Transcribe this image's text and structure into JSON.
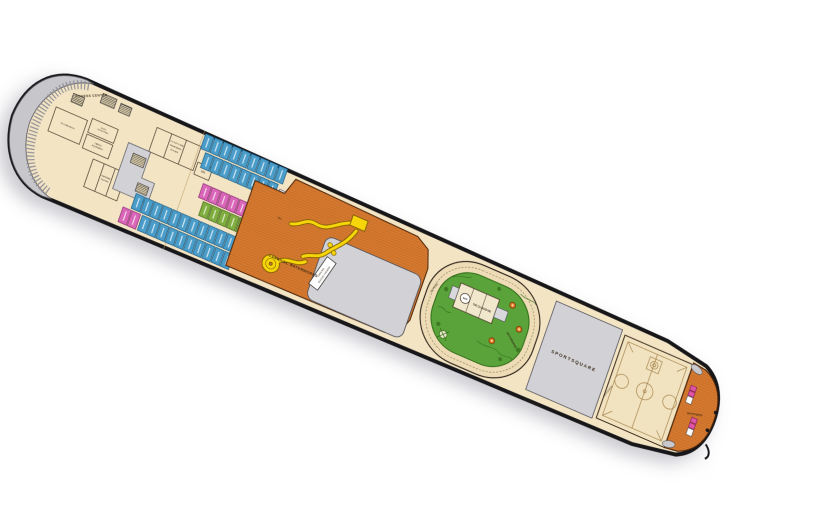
{
  "page": {
    "background": "#ffffff",
    "description_labels_only": true
  },
  "colors": {
    "deck_beige": "#f3e4c4",
    "hull_outline": "#17171a",
    "open_space_gray": "#d2d2d6",
    "bow_crescent_gray": "#c6c6cb",
    "orange_deck": "#d4792f",
    "orange_plank": "#b35d1e",
    "waterslide_yellow": "#f6d60a",
    "mini_golf_green": "#5aa33a",
    "cabin_blue": "#4a9cc9",
    "cabin_blue_dark": "#1d5f88",
    "cabin_pink": "#d966b8",
    "cabin_pink_dark": "#8d2f74",
    "cabin_green": "#7fae3e",
    "cabin_green_dark": "#4a6b1f",
    "court_line": "#a8854e",
    "label_dark": "#3a2a1a",
    "open_label_gray": "#8b8b93",
    "golf_hole_orange": "#e07820"
  },
  "deck": {
    "labels": {
      "fitness_center": "FITNESS CENTER",
      "plyometrics": "PLYOMETRICS",
      "body_sculpting": [
        "BODY",
        "SCULPTING"
      ],
      "cardio": [
        "CARDIO",
        "EQUIPMENT"
      ],
      "thermal_suites": [
        "THERMAL",
        "SUITES"
      ],
      "cloud9_spa": [
        "CLOUD 9 SPA",
        "TREATMENT",
        "ROOMS"
      ],
      "spa": "SPA",
      "wc": "WC",
      "waterworks": "CARNIVAL WATERWORKS",
      "seaside_theatre": [
        "CARNIVAL",
        "SEASIDE THEATRE"
      ],
      "skyride": "SKYRIDE",
      "bar": "BAR",
      "the_clubhouse": "THE CLUBHOUSE",
      "skygreens": "SKYGREENS",
      "skycourse_top": "SKYCOURSE",
      "skycourse_bottom": "SKYCOURSE",
      "skycourse_court": "SKYCOURSE",
      "sportsquare": "SPORTSQUARE",
      "skyfitness": "SKYFITNESS"
    },
    "cabin_rows": [
      {
        "y": 8,
        "x0": 196,
        "count": 9,
        "w": 9,
        "h": 16,
        "gap": 1,
        "color": "blue"
      },
      {
        "y": 26,
        "x0": 202,
        "count": 8,
        "w": 9,
        "h": 16,
        "gap": 1,
        "color": "blue"
      },
      {
        "y": 56,
        "x0": 210,
        "count": 6,
        "w": 9,
        "h": 15,
        "gap": 1,
        "color": "pink"
      },
      {
        "y": 73,
        "x0": 216,
        "count": 8,
        "w": 9,
        "h": 15,
        "gap": 1,
        "color": "green"
      },
      {
        "y": 93,
        "x0": 150,
        "count": 11,
        "w": 9,
        "h": 16,
        "gap": 1,
        "color": "blue"
      },
      {
        "y": 111,
        "x0": 142,
        "count": 2,
        "w": 9,
        "h": 16,
        "gap": 1,
        "color": "pink"
      },
      {
        "y": 111,
        "x0": 163,
        "count": 10,
        "w": 9,
        "h": 16,
        "gap": 1,
        "color": "blue"
      }
    ]
  }
}
